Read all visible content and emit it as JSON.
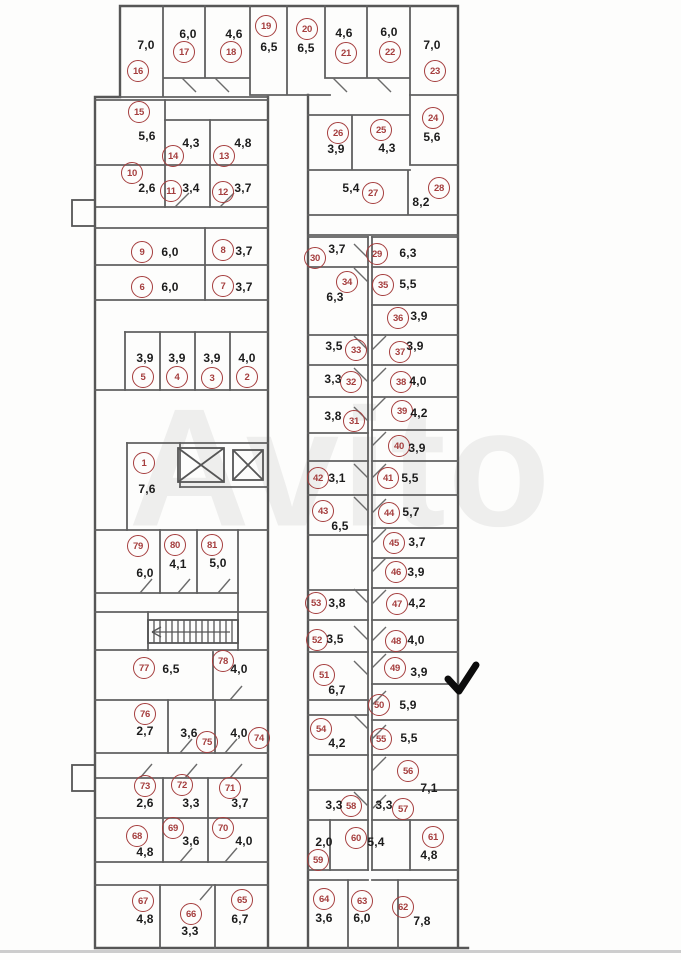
{
  "watermark": {
    "text": "Avito"
  },
  "colors": {
    "circle": "#a53e3e",
    "walls": "#5f5f5f",
    "area_text": "#1c1c1c",
    "checkmark": "#0c0c0c"
  },
  "rooms": [
    {
      "n": "1",
      "area": "7,6",
      "cx": 144,
      "cy": 463,
      "ax": 147,
      "ay": 489
    },
    {
      "n": "2",
      "area": "4,0",
      "cx": 247,
      "cy": 377,
      "ax": 247,
      "ay": 358
    },
    {
      "n": "3",
      "area": "3,9",
      "cx": 212,
      "cy": 378,
      "ax": 212,
      "ay": 358
    },
    {
      "n": "4",
      "area": "3,9",
      "cx": 177,
      "cy": 377,
      "ax": 177,
      "ay": 358
    },
    {
      "n": "5",
      "area": "3,9",
      "cx": 143,
      "cy": 377,
      "ax": 145,
      "ay": 358
    },
    {
      "n": "6",
      "area": "6,0",
      "cx": 142,
      "cy": 287,
      "ax": 170,
      "ay": 287
    },
    {
      "n": "7",
      "area": "3,7",
      "cx": 223,
      "cy": 286,
      "ax": 244,
      "ay": 287
    },
    {
      "n": "8",
      "area": "3,7",
      "cx": 223,
      "cy": 250,
      "ax": 244,
      "ay": 251
    },
    {
      "n": "9",
      "area": "6,0",
      "cx": 142,
      "cy": 252,
      "ax": 170,
      "ay": 252
    },
    {
      "n": "10",
      "area": "2,6",
      "cx": 132,
      "cy": 173,
      "ax": 147,
      "ay": 188
    },
    {
      "n": "11",
      "area": "3,4",
      "cx": 171,
      "cy": 191,
      "ax": 191,
      "ay": 188
    },
    {
      "n": "12",
      "area": "3,7",
      "cx": 223,
      "cy": 192,
      "ax": 243,
      "ay": 188
    },
    {
      "n": "13",
      "area": "4,8",
      "cx": 224,
      "cy": 156,
      "ax": 243,
      "ay": 143
    },
    {
      "n": "14",
      "area": "4,3",
      "cx": 173,
      "cy": 156,
      "ax": 191,
      "ay": 143
    },
    {
      "n": "15",
      "area": "5,6",
      "cx": 139,
      "cy": 112,
      "ax": 147,
      "ay": 136
    },
    {
      "n": "16",
      "area": "7,0",
      "cx": 138,
      "cy": 71,
      "ax": 146,
      "ay": 45
    },
    {
      "n": "17",
      "area": "6,0",
      "cx": 184,
      "cy": 52,
      "ax": 188,
      "ay": 34
    },
    {
      "n": "18",
      "area": "4,6",
      "cx": 231,
      "cy": 52,
      "ax": 234,
      "ay": 34
    },
    {
      "n": "19",
      "area": "6,5",
      "cx": 266,
      "cy": 26,
      "ax": 269,
      "ay": 47
    },
    {
      "n": "20",
      "area": "6,5",
      "cx": 307,
      "cy": 29,
      "ax": 306,
      "ay": 48
    },
    {
      "n": "21",
      "area": "4,6",
      "cx": 346,
      "cy": 53,
      "ax": 344,
      "ay": 33
    },
    {
      "n": "22",
      "area": "6,0",
      "cx": 390,
      "cy": 52,
      "ax": 389,
      "ay": 32
    },
    {
      "n": "23",
      "area": "7,0",
      "cx": 435,
      "cy": 71,
      "ax": 432,
      "ay": 45
    },
    {
      "n": "24",
      "area": "5,6",
      "cx": 433,
      "cy": 118,
      "ax": 432,
      "ay": 137
    },
    {
      "n": "25",
      "area": "4,3",
      "cx": 381,
      "cy": 130,
      "ax": 387,
      "ay": 148
    },
    {
      "n": "26",
      "area": "3,9",
      "cx": 338,
      "cy": 133,
      "ax": 336,
      "ay": 149
    },
    {
      "n": "27",
      "area": "5,4",
      "cx": 373,
      "cy": 193,
      "ax": 351,
      "ay": 188
    },
    {
      "n": "28",
      "area": "8,2",
      "cx": 439,
      "cy": 188,
      "ax": 421,
      "ay": 202
    },
    {
      "n": "29",
      "area": "6,3",
      "cx": 377,
      "cy": 254,
      "ax": 408,
      "ay": 253
    },
    {
      "n": "30",
      "area": "3,7",
      "cx": 315,
      "cy": 258,
      "ax": 337,
      "ay": 249
    },
    {
      "n": "31",
      "area": "3,8",
      "cx": 354,
      "cy": 421,
      "ax": 333,
      "ay": 416
    },
    {
      "n": "32",
      "area": "3,3",
      "cx": 351,
      "cy": 382,
      "ax": 333,
      "ay": 379
    },
    {
      "n": "33",
      "area": "3,5",
      "cx": 356,
      "cy": 350,
      "ax": 334,
      "ay": 346
    },
    {
      "n": "34",
      "area": "6,3",
      "cx": 347,
      "cy": 282,
      "ax": 335,
      "ay": 297
    },
    {
      "n": "35",
      "area": "5,5",
      "cx": 383,
      "cy": 285,
      "ax": 408,
      "ay": 284
    },
    {
      "n": "36",
      "area": "3,9",
      "cx": 398,
      "cy": 318,
      "ax": 419,
      "ay": 316
    },
    {
      "n": "37",
      "area": "3,9",
      "cx": 400,
      "cy": 352,
      "ax": 415,
      "ay": 346
    },
    {
      "n": "38",
      "area": "4,0",
      "cx": 401,
      "cy": 382,
      "ax": 418,
      "ay": 381
    },
    {
      "n": "39",
      "area": "4,2",
      "cx": 402,
      "cy": 411,
      "ax": 419,
      "ay": 413
    },
    {
      "n": "40",
      "area": "3,9",
      "cx": 399,
      "cy": 446,
      "ax": 417,
      "ay": 448
    },
    {
      "n": "41",
      "area": "5,5",
      "cx": 388,
      "cy": 478,
      "ax": 410,
      "ay": 478
    },
    {
      "n": "42",
      "area": "3,1",
      "cx": 318,
      "cy": 478,
      "ax": 337,
      "ay": 478
    },
    {
      "n": "43",
      "area": "6,5",
      "cx": 323,
      "cy": 511,
      "ax": 340,
      "ay": 526
    },
    {
      "n": "44",
      "area": "5,7",
      "cx": 389,
      "cy": 513,
      "ax": 411,
      "ay": 512
    },
    {
      "n": "45",
      "area": "3,7",
      "cx": 394,
      "cy": 543,
      "ax": 417,
      "ay": 542
    },
    {
      "n": "46",
      "area": "3,9",
      "cx": 396,
      "cy": 572,
      "ax": 416,
      "ay": 572
    },
    {
      "n": "47",
      "area": "4,2",
      "cx": 397,
      "cy": 604,
      "ax": 417,
      "ay": 603
    },
    {
      "n": "48",
      "area": "4,0",
      "cx": 396,
      "cy": 641,
      "ax": 416,
      "ay": 640
    },
    {
      "n": "49",
      "area": "3,9",
      "cx": 395,
      "cy": 668,
      "ax": 419,
      "ay": 672
    },
    {
      "n": "50",
      "area": "5,9",
      "cx": 379,
      "cy": 705,
      "ax": 408,
      "ay": 705
    },
    {
      "n": "51",
      "area": "6,7",
      "cx": 324,
      "cy": 675,
      "ax": 337,
      "ay": 690
    },
    {
      "n": "52",
      "area": "3,5",
      "cx": 317,
      "cy": 640,
      "ax": 335,
      "ay": 639
    },
    {
      "n": "53",
      "area": "3,8",
      "cx": 316,
      "cy": 603,
      "ax": 337,
      "ay": 603
    },
    {
      "n": "54",
      "area": "4,2",
      "cx": 321,
      "cy": 729,
      "ax": 337,
      "ay": 743
    },
    {
      "n": "55",
      "area": "5,5",
      "cx": 381,
      "cy": 739,
      "ax": 409,
      "ay": 738
    },
    {
      "n": "56",
      "area": "7,1",
      "cx": 408,
      "cy": 771,
      "ax": 429,
      "ay": 788
    },
    {
      "n": "57",
      "area": "3,3",
      "cx": 403,
      "cy": 809,
      "ax": 384,
      "ay": 805
    },
    {
      "n": "58",
      "area": "3,3",
      "cx": 351,
      "cy": 806,
      "ax": 334,
      "ay": 805
    },
    {
      "n": "59",
      "area": "2,0",
      "cx": 318,
      "cy": 860,
      "ax": 324,
      "ay": 842
    },
    {
      "n": "60",
      "area": "5,4",
      "cx": 356,
      "cy": 838,
      "ax": 376,
      "ay": 842
    },
    {
      "n": "61",
      "area": "4,8",
      "cx": 433,
      "cy": 837,
      "ax": 429,
      "ay": 855
    },
    {
      "n": "62",
      "area": "7,8",
      "cx": 403,
      "cy": 907,
      "ax": 422,
      "ay": 921
    },
    {
      "n": "63",
      "area": "6,0",
      "cx": 362,
      "cy": 901,
      "ax": 362,
      "ay": 918
    },
    {
      "n": "64",
      "area": "3,6",
      "cx": 324,
      "cy": 899,
      "ax": 324,
      "ay": 918
    },
    {
      "n": "65",
      "area": "6,7",
      "cx": 242,
      "cy": 900,
      "ax": 240,
      "ay": 919
    },
    {
      "n": "66",
      "area": "3,3",
      "cx": 191,
      "cy": 914,
      "ax": 190,
      "ay": 931
    },
    {
      "n": "67",
      "area": "4,8",
      "cx": 143,
      "cy": 901,
      "ax": 145,
      "ay": 919
    },
    {
      "n": "68",
      "area": "4,8",
      "cx": 137,
      "cy": 836,
      "ax": 145,
      "ay": 852
    },
    {
      "n": "69",
      "area": "3,6",
      "cx": 173,
      "cy": 828,
      "ax": 191,
      "ay": 841
    },
    {
      "n": "70",
      "area": "4,0",
      "cx": 223,
      "cy": 828,
      "ax": 244,
      "ay": 841
    },
    {
      "n": "71",
      "area": "3,7",
      "cx": 230,
      "cy": 788,
      "ax": 240,
      "ay": 803
    },
    {
      "n": "72",
      "area": "3,3",
      "cx": 182,
      "cy": 785,
      "ax": 191,
      "ay": 803
    },
    {
      "n": "73",
      "area": "2,6",
      "cx": 145,
      "cy": 786,
      "ax": 145,
      "ay": 803
    },
    {
      "n": "74",
      "area": "4,0",
      "cx": 259,
      "cy": 738,
      "ax": 239,
      "ay": 733
    },
    {
      "n": "75",
      "area": "3,6",
      "cx": 207,
      "cy": 742,
      "ax": 189,
      "ay": 733
    },
    {
      "n": "76",
      "area": "2,7",
      "cx": 145,
      "cy": 714,
      "ax": 145,
      "ay": 731
    },
    {
      "n": "77",
      "area": "6,5",
      "cx": 144,
      "cy": 668,
      "ax": 171,
      "ay": 669
    },
    {
      "n": "78",
      "area": "4,0",
      "cx": 223,
      "cy": 661,
      "ax": 239,
      "ay": 669
    },
    {
      "n": "79",
      "area": "6,0",
      "cx": 138,
      "cy": 546,
      "ax": 145,
      "ay": 573
    },
    {
      "n": "80",
      "area": "4,1",
      "cx": 175,
      "cy": 545,
      "ax": 178,
      "ay": 564
    },
    {
      "n": "81",
      "area": "5,0",
      "cx": 212,
      "cy": 545,
      "ax": 218,
      "ay": 563
    }
  ]
}
